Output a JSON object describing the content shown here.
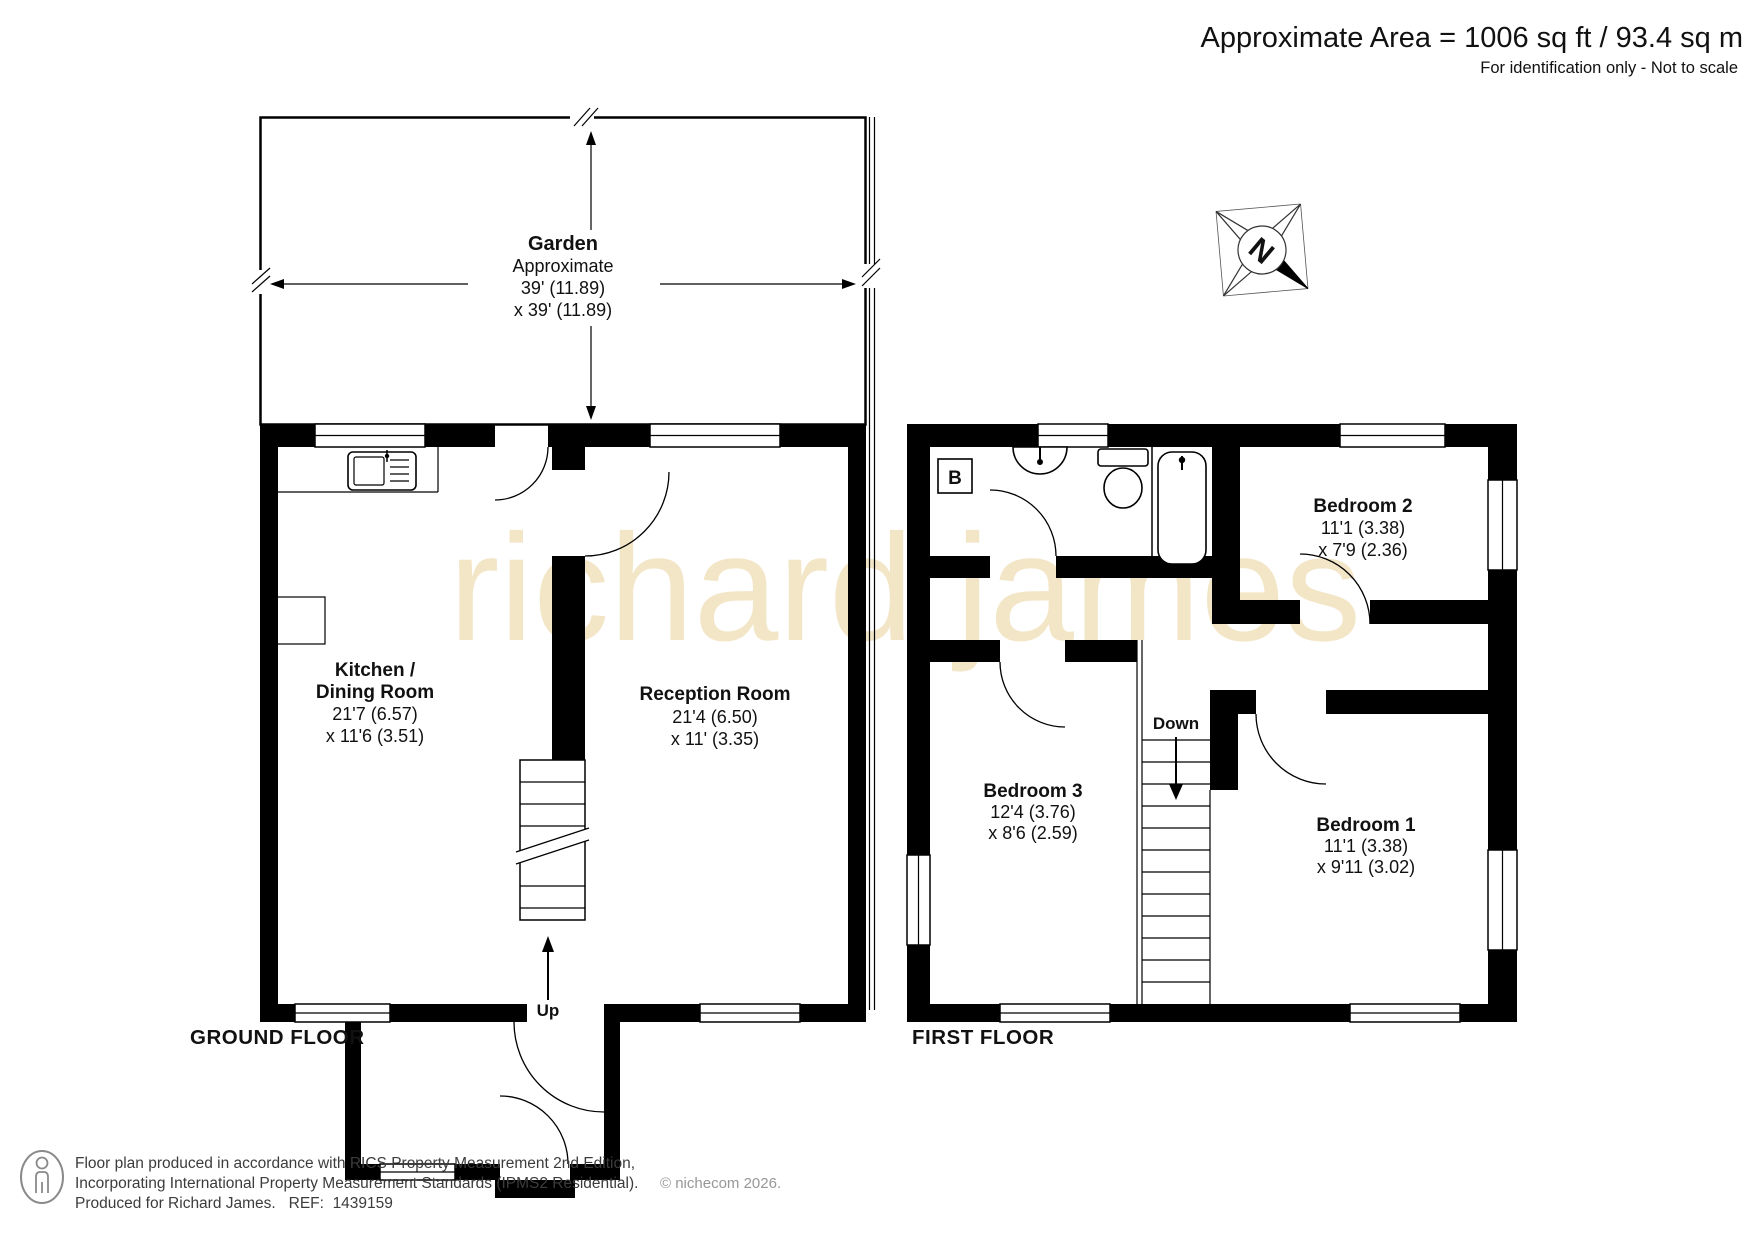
{
  "header": {
    "area": "Approximate Area = 1006 sq ft / 93.4 sq m",
    "disclaimer": "For identification only - Not to scale"
  },
  "watermark": "richard james",
  "compass": {
    "north": "N"
  },
  "ground_floor": {
    "label": "GROUND FLOOR",
    "garden": {
      "name": "Garden",
      "note": "Approximate",
      "dim1": "39' (11.89)",
      "dim2": "x 39' (11.89)"
    },
    "kitchen": {
      "name1": "Kitchen /",
      "name2": "Dining Room",
      "dim1": "21'7 (6.57)",
      "dim2": "x 11'6 (3.51)"
    },
    "reception": {
      "name": "Reception Room",
      "dim1": "21'4 (6.50)",
      "dim2": "x 11' (3.35)"
    },
    "up": "Up"
  },
  "first_floor": {
    "label": "FIRST FLOOR",
    "bedroom1": {
      "name": "Bedroom 1",
      "dim1": "11'1 (3.38)",
      "dim2": "x 9'11 (3.02)"
    },
    "bedroom2": {
      "name": "Bedroom 2",
      "dim1": "11'1 (3.38)",
      "dim2": "x 7'9 (2.36)"
    },
    "bedroom3": {
      "name": "Bedroom 3",
      "dim1": "12'4 (3.76)",
      "dim2": "x 8'6 (2.59)"
    },
    "down": "Down",
    "boiler": "B"
  },
  "footer": {
    "line1": "Floor plan produced in accordance with RICS Property Measurement 2nd Edition,",
    "line2": "Incorporating International Property Measurement Standards (IPMS2 Residential).",
    "copyright": "© nichecom 2026.",
    "line3": "Produced for Richard James.   REF:  1439159"
  }
}
